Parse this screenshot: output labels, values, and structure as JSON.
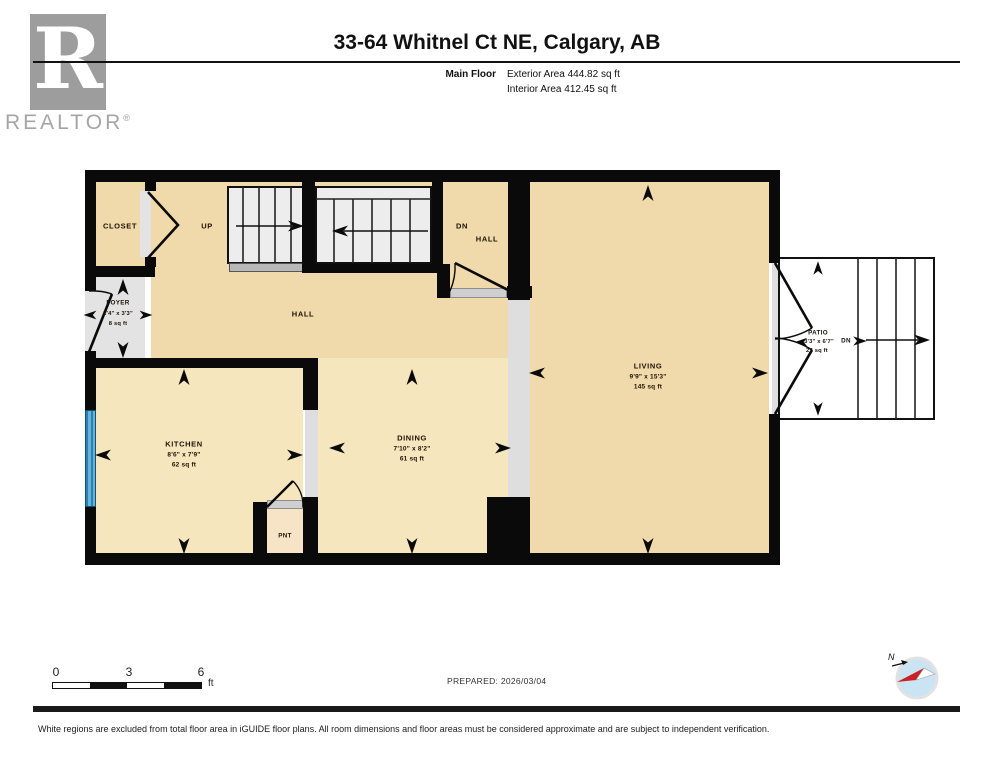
{
  "header": {
    "title": "33-64 Whitnel Ct NE, Calgary, AB",
    "floor_label": "Main Floor",
    "exterior_area": "Exterior Area 444.82 sq ft",
    "interior_area": "Interior Area 412.45 sq ft"
  },
  "branding": {
    "wordmark": "REALTOR",
    "registered": "®",
    "logo_letter": "R"
  },
  "plan": {
    "rooms": {
      "closet": {
        "name": "CLOSET"
      },
      "up": {
        "name": "UP"
      },
      "dn": {
        "name": "DN"
      },
      "hall_upper": {
        "name": "HALL"
      },
      "hall": {
        "name": "HALL"
      },
      "foyer": {
        "name": "FOYER",
        "dims": "2'4\" x 3'3\"",
        "area": "8 sq ft"
      },
      "kitchen": {
        "name": "KITCHEN",
        "dims": "8'6\" x 7'9\"",
        "area": "62 sq ft"
      },
      "dining": {
        "name": "DINING",
        "dims": "7'10\" x 8'2\"",
        "area": "61 sq ft"
      },
      "living": {
        "name": "LIVING",
        "dims": "9'9\" x 15'3\"",
        "area": "145 sq ft"
      },
      "pantry": {
        "name": "PNT"
      },
      "patio": {
        "name": "PATIO",
        "dims": "3'3\" x 6'7\"",
        "area": "22 sq ft"
      },
      "patio_dn": {
        "name": "DN"
      }
    },
    "colors": {
      "room_tan": "#f0d9aa",
      "room_tan_light": "#f6e6bd",
      "pantry_tan": "#f7e3c6",
      "excluded_gray": "#e3e3e3",
      "wall_black": "#0a0a0a",
      "window_blue": "#63b5dc"
    }
  },
  "footer": {
    "scale": {
      "start": "0",
      "mid": "3",
      "end": "6",
      "unit": "ft"
    },
    "prepared": "PREPARED: 2026/03/04",
    "compass_north": "N",
    "disclaimer": "White regions are excluded from total floor area in iGUIDE floor plans. All room dimensions and floor areas must be considered approximate and are subject to independent verification."
  }
}
